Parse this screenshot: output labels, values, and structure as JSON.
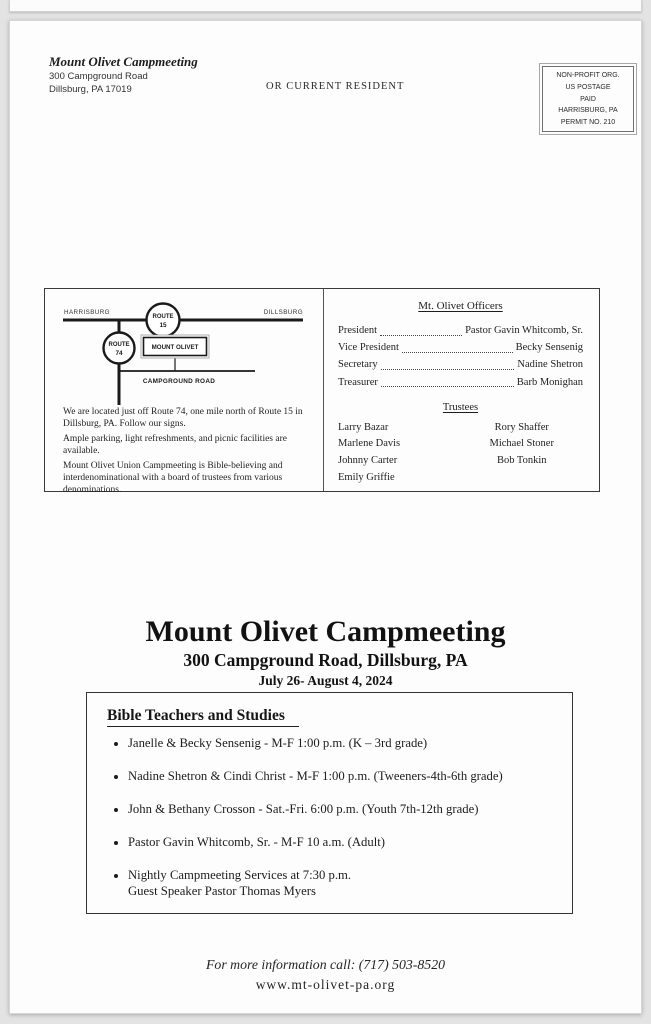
{
  "sender": {
    "name": "Mount Olivet Campmeeting",
    "address_line1": "300 Campground Road",
    "address_line2": "Dillsburg, PA 17019"
  },
  "recipient_line": "OR CURRENT RESIDENT",
  "postage": {
    "lines": [
      "NON-PROFIT ORG.",
      "US POSTAGE",
      "PAID",
      "HARRISBURG, PA",
      "PERMIT NO. 210"
    ]
  },
  "map": {
    "left_city": "HARRISBURG",
    "right_city": "DILLSBURG",
    "route15_line1": "ROUTE",
    "route15_line2": "15",
    "route74_line1": "ROUTE",
    "route74_line2": "74",
    "mount_olivet": "MOUNT OLIVET",
    "campground_road": "CAMPGROUND ROAD"
  },
  "directions": [
    "We are located just off Route 74, one mile north of Route 15 in Dillsburg, PA. Follow our signs.",
    "Ample parking, light refreshments, and picnic facilities are available.",
    "Mount Olivet Union Campmeeting is Bible-believing and interdenominational with a board of trustees from various denominations."
  ],
  "officers": {
    "title": "Mt. Olivet Officers",
    "rows": [
      {
        "role": "President",
        "name": "Pastor Gavin Whitcomb, Sr."
      },
      {
        "role": "Vice President",
        "name": "Becky Sensenig"
      },
      {
        "role": "Secretary",
        "name": "Nadine Shetron"
      },
      {
        "role": "Treasurer",
        "name": "Barb Monighan"
      }
    ]
  },
  "trustees": {
    "title": "Trustees",
    "left": [
      "Larry Bazar",
      "Marlene Davis",
      "Johnny Carter",
      "Emily Griffie"
    ],
    "right": [
      "Rory Shaffer",
      "Michael Stoner",
      "Bob Tonkin"
    ]
  },
  "main": {
    "title": "Mount Olivet Campmeeting",
    "subtitle": "300 Campground Road, Dillsburg, PA",
    "dates": "July 26- August 4, 2024"
  },
  "studies": {
    "title": "Bible Teachers and Studies",
    "items": [
      {
        "line1": "Janelle & Becky Sensenig - M-F 1:00 p.m. (K – 3rd grade)",
        "line2": ""
      },
      {
        "line1": "Nadine Shetron & Cindi Christ - M-F 1:00 p.m. (Tweeners-4th-6th grade)",
        "line2": ""
      },
      {
        "line1": "John & Bethany Crosson - Sat.-Fri. 6:00 p.m. (Youth 7th-12th grade)",
        "line2": ""
      },
      {
        "line1": "Pastor Gavin Whitcomb, Sr. - M-F 10 a.m.  (Adult)",
        "line2": ""
      },
      {
        "line1": "Nightly Campmeeting Services at 7:30 p.m.",
        "line2": "Guest Speaker Pastor Thomas Myers"
      }
    ]
  },
  "footer": {
    "info_line": "For more information call: (717) 503-8520",
    "website": "www.mt-olivet-pa.org"
  }
}
